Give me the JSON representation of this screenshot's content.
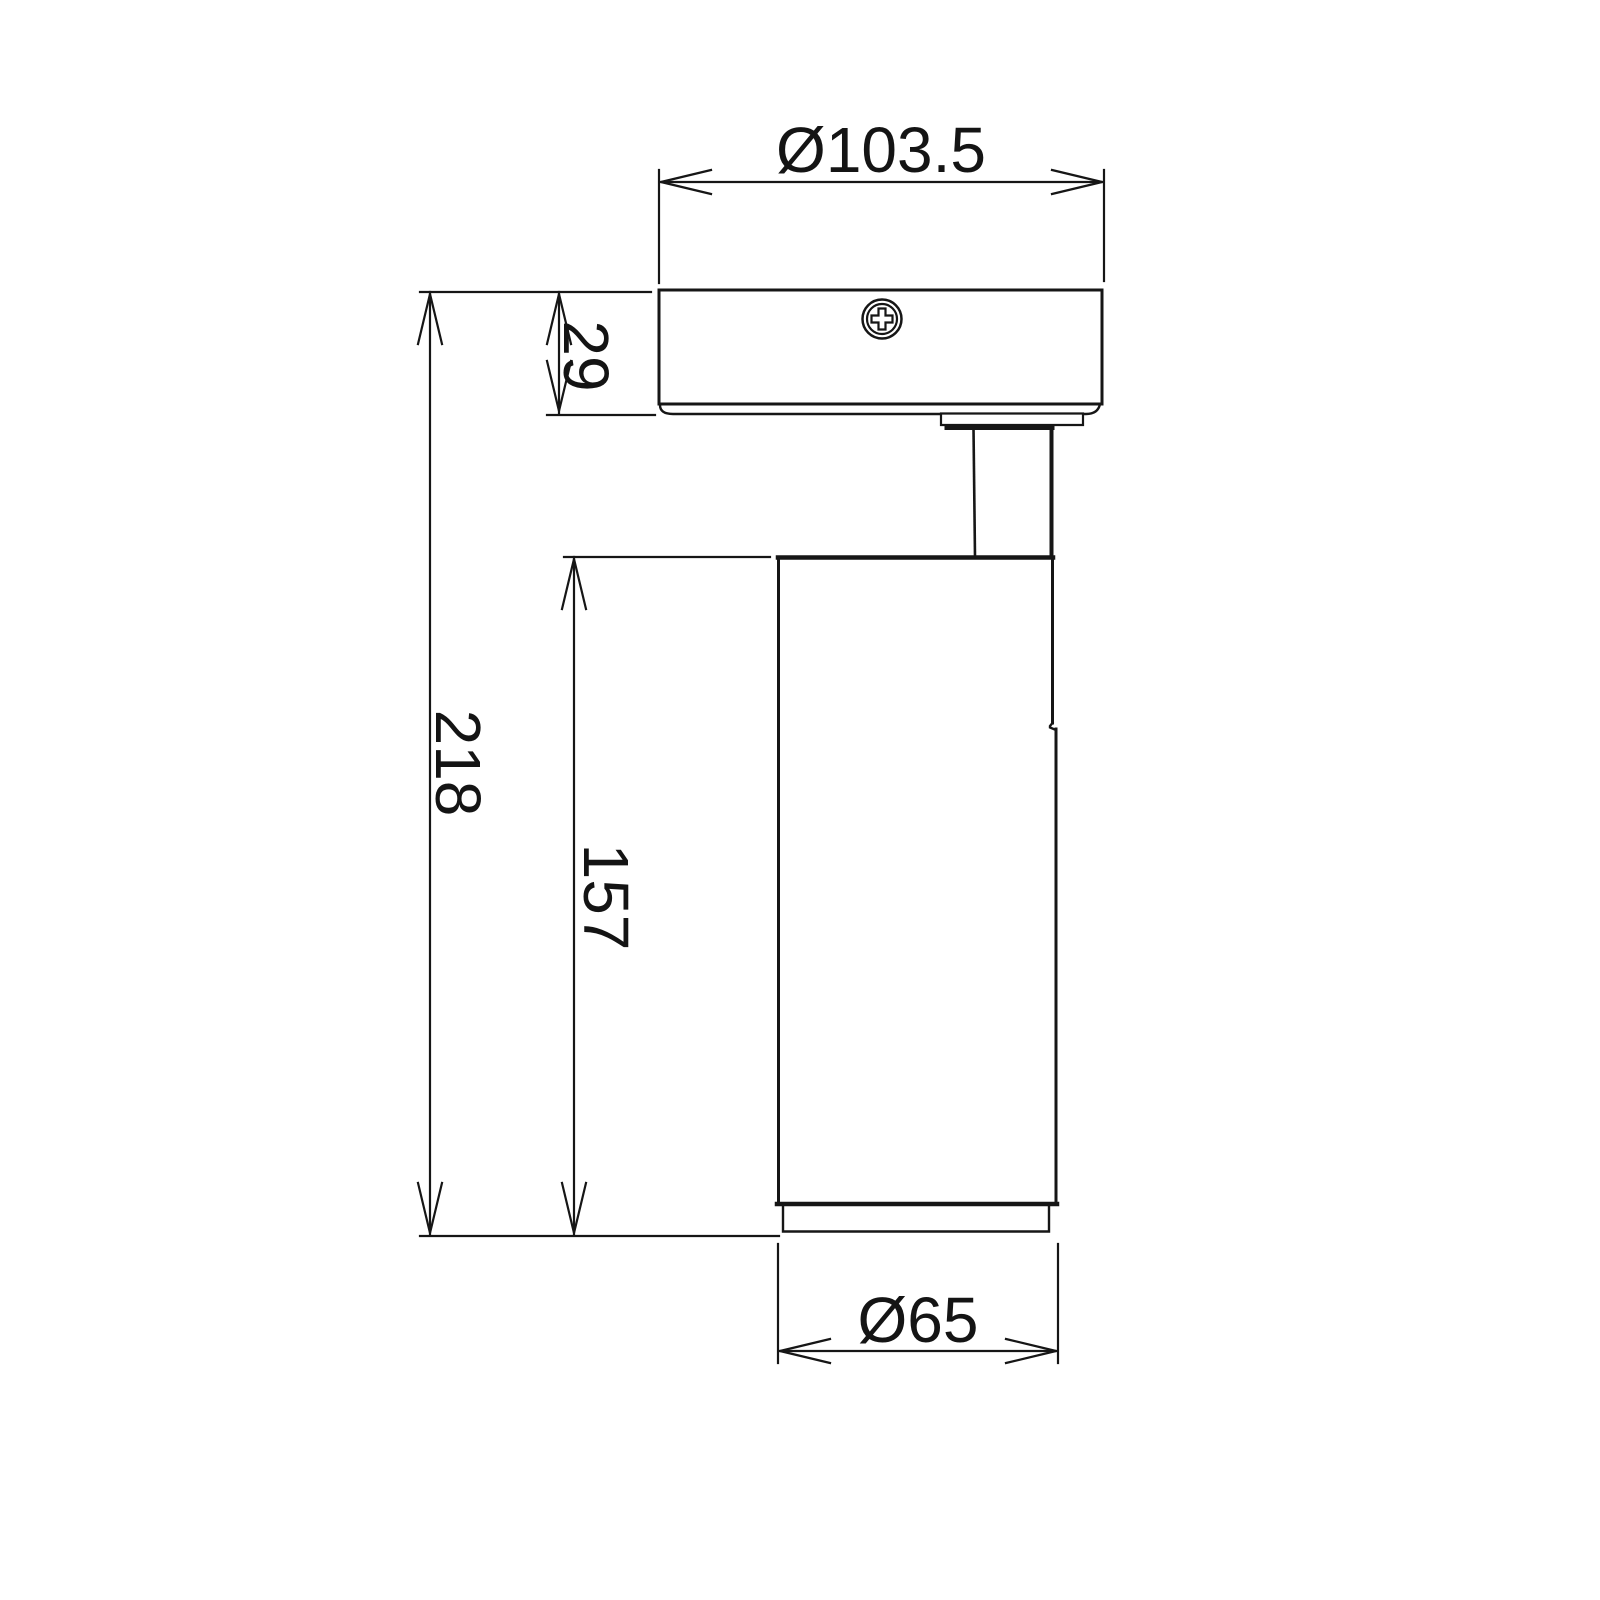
{
  "colors": {
    "background": "#ffffff",
    "line": "#161616",
    "text": "#141414"
  },
  "dimensions": {
    "canopy_diameter": "Ø103.5",
    "canopy_height": "29",
    "overall_height": "218",
    "body_height": "157",
    "body_diameter": "Ø65"
  }
}
